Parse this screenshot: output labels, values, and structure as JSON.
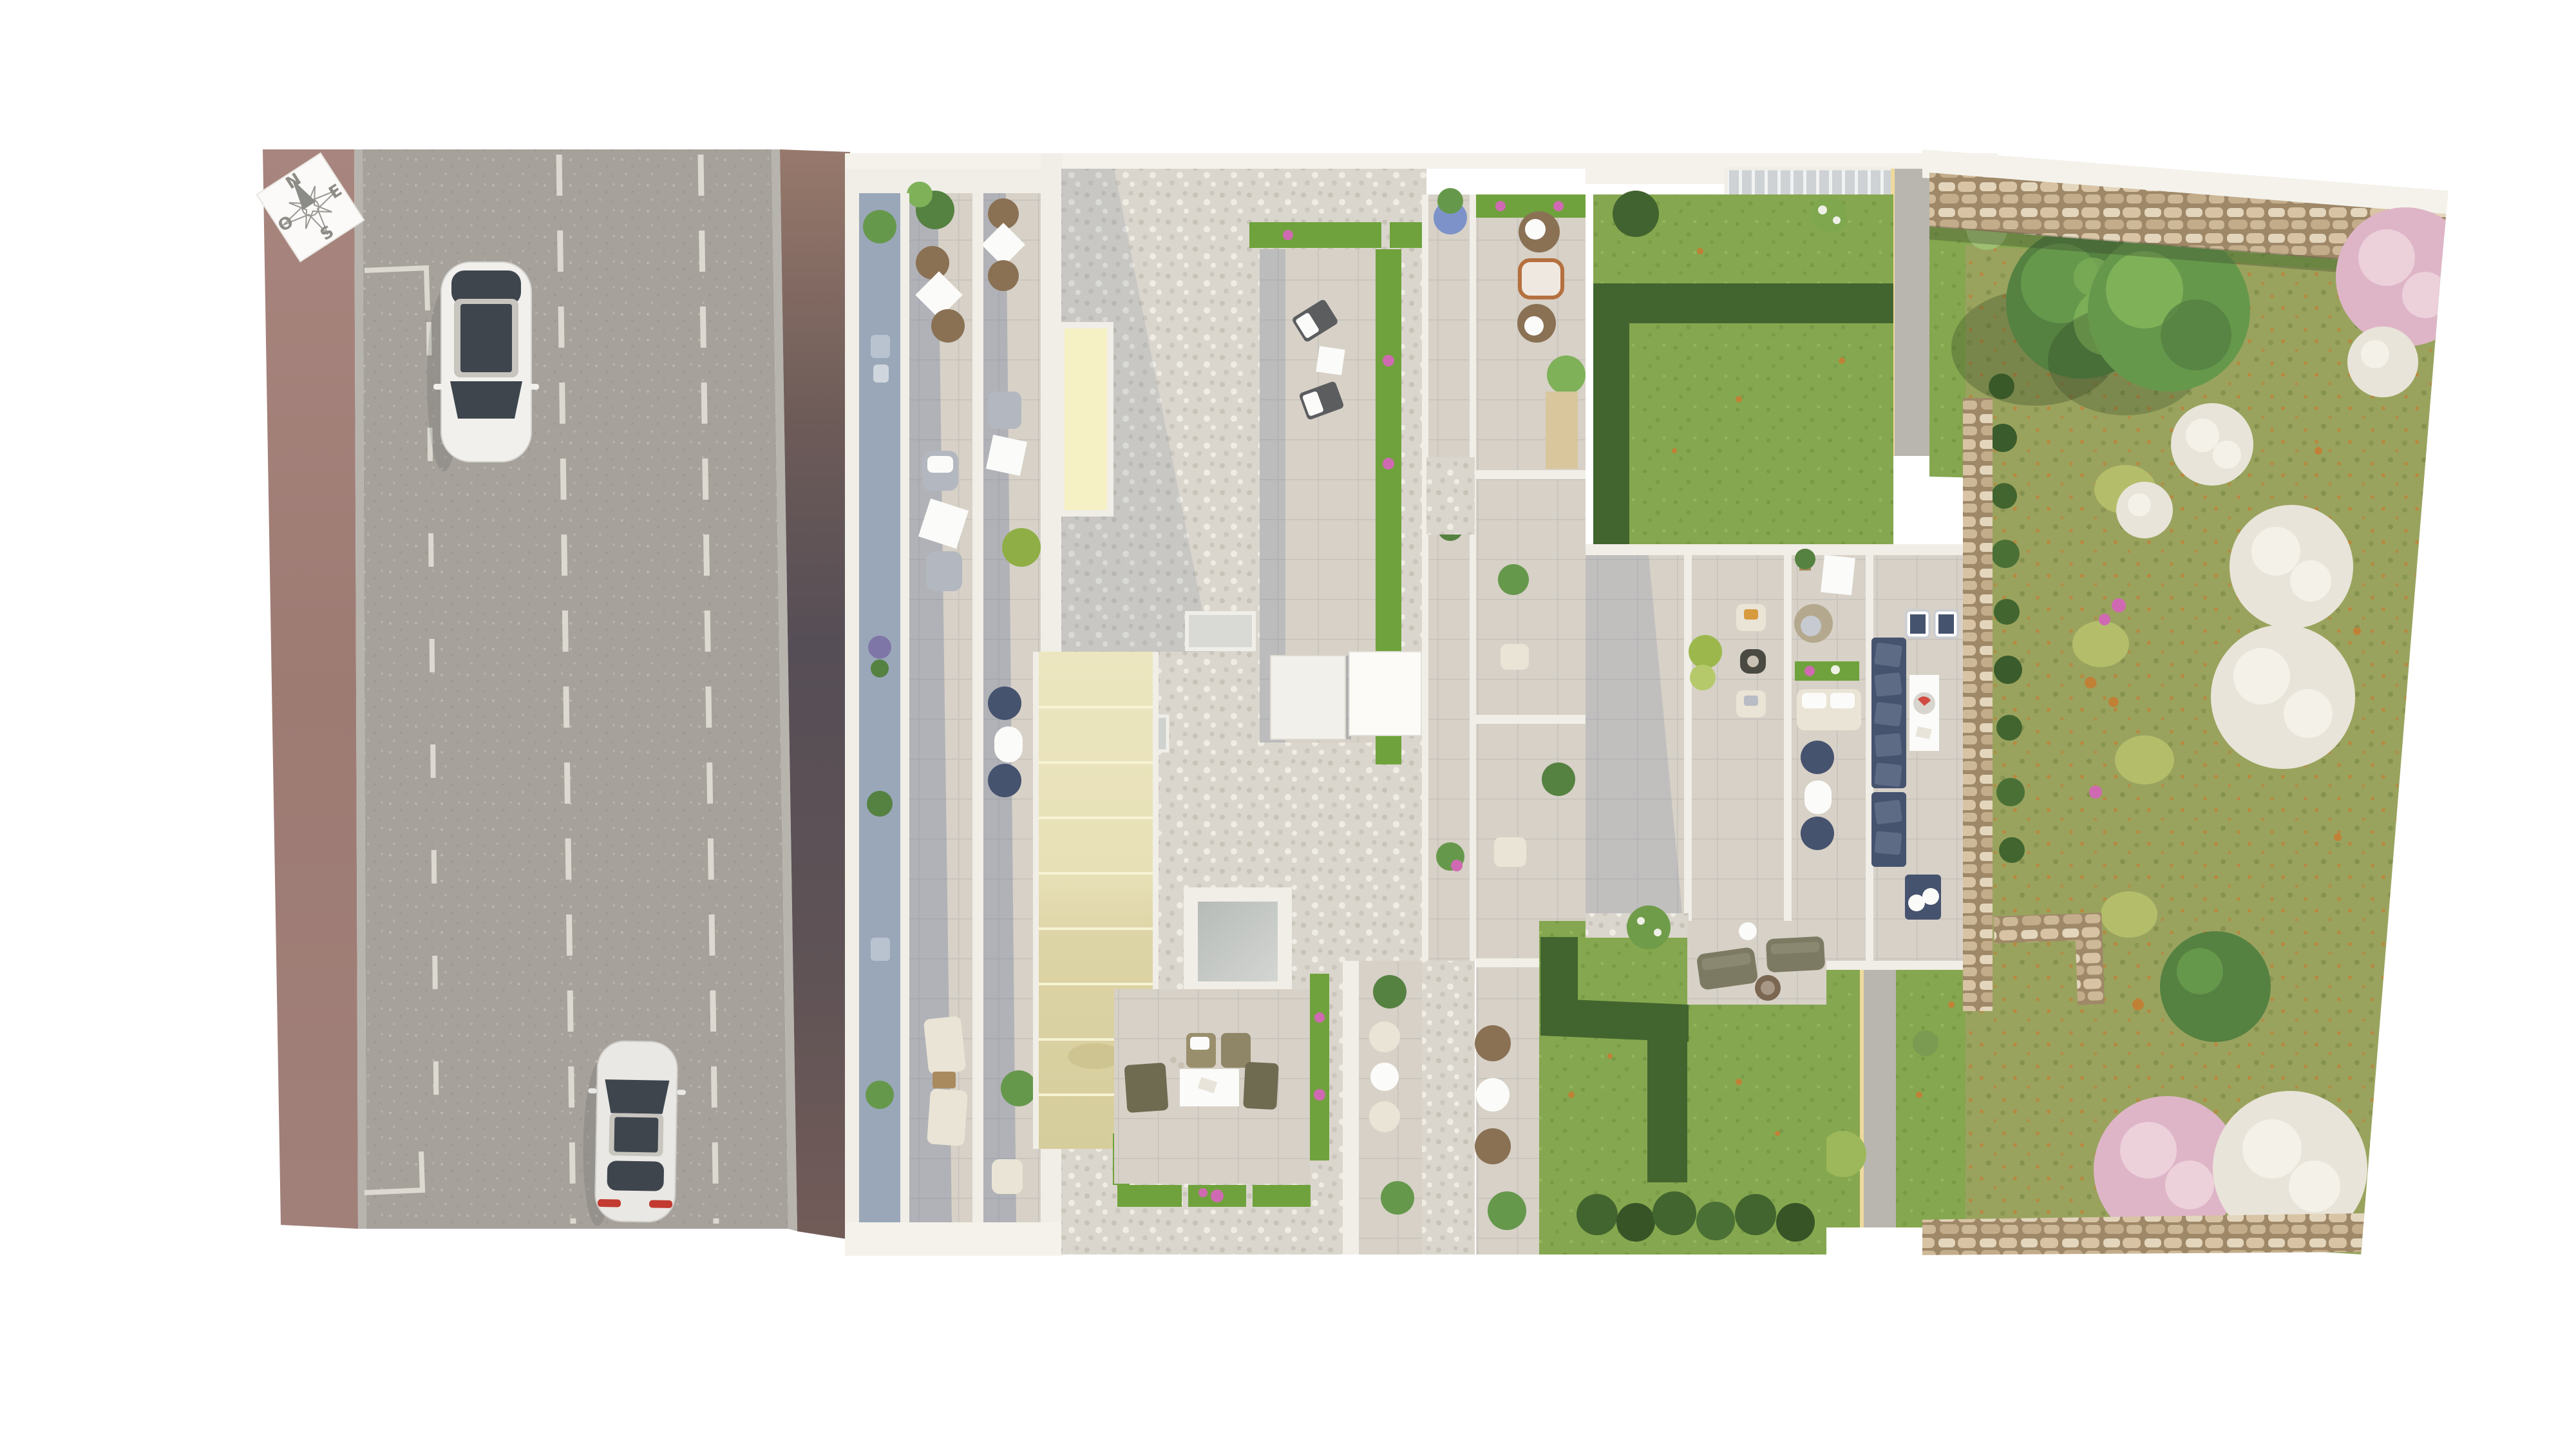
{
  "scene": {
    "type": "aerial-architectural-site-plan",
    "description": "Top-down photorealistic render of a residential building: street with two white cars on the left, white-gravel roof with terraces, skylights and a cream awning in the middle, private lawns, stone walls, hedges and a wildflower meadow with blossom trees on the right.",
    "compass": {
      "n": "N",
      "e": "E",
      "s": "S",
      "o": "O"
    },
    "road": {
      "surface": "asphalt",
      "lane_dashed_lines": 2,
      "parking_bays": 2,
      "cars": [
        {
          "name": "car-top",
          "body": "white",
          "heading": "south",
          "roof": "dark glass"
        },
        {
          "name": "car-bottom",
          "body": "white",
          "heading": "north",
          "taillights": "red"
        }
      ]
    },
    "building": {
      "roof": "white pebble gravel",
      "skylights": [
        "pale-yellow strip",
        "twin white roof hatch",
        "large gray skylight",
        "two small gray skylights"
      ],
      "awning": "long cream slatted pergola",
      "terraces": "beige tiled rooftop terraces with parapets, planters and outdoor furniture",
      "furniture": [
        "brown round chairs",
        "gray armchairs",
        "cream loungers",
        "navy corner sofa",
        "white dining tables",
        "fire-pit table",
        "wicker chairs with rug"
      ]
    },
    "gardens": {
      "lawns": 4,
      "hedges": "clipped dark green bands",
      "walls": "dry-stone gabion walls on north, east and south edges",
      "trees": [
        "two large green canopies",
        "pink blossom trees",
        "white blossom trees"
      ],
      "meadow": "olive wildflower strip with orange leaf litter along the right edge",
      "paths": [
        "gray concrete path with cream edge",
        "sandy path"
      ]
    }
  },
  "colors": {
    "curb": "#b7b4ae",
    "road": "#a6a19a",
    "roadDot1": "#c9c4b8",
    "roadDot2": "#8f8a82",
    "marking": "#dcd9d1",
    "carBody": "#f1f0ed",
    "carBody2": "#e9e8e4",
    "carGlass": "#3e454d",
    "carRoof": "#c8c5bf",
    "carTail": "#c23a30",
    "parapet": "#f0eee7",
    "slabTop": "#f4f2eb",
    "balcony": "#9aa7b9",
    "tile": "#d7d1c7",
    "tileLine": "rgba(110,118,135,0.16)",
    "tileShadow": "rgba(96,112,148,0.32)",
    "gravel": "#dad6cd",
    "gravelDot": "#b7b2a5",
    "gravelDot2": "#efece4",
    "yellowSky": "#f5f1c4",
    "awnLight": "#ece6c0",
    "awnDark": "#d6cd9c",
    "awnLine": "#f7f3d4",
    "planter": "#6fa23c",
    "flowerPink": "#cf6ab2",
    "hedge": "#42652f",
    "lawn": "#85a74f",
    "lawnDot": "#6d8f3f",
    "meadow": "#99a35e",
    "meadowDot": "#c08137",
    "stone": "#cdb897",
    "stoneDark": "#9f8868",
    "stoneLight": "#e3d6bd",
    "louver": "#ced2d5",
    "path": "#b9b6b0",
    "pathEdge": "#eeda9d",
    "sand": "#d9c69d",
    "navy": "#46536f",
    "navyLight": "#5d6b85",
    "cream": "#e9e4d5",
    "olive": "#6f6b51",
    "oliveSofa": "#7c7a62",
    "wood": "#a98a5f",
    "wicker": "#8a7154",
    "treeG1": "#558141",
    "treeG2": "#66984c",
    "treeG3": "#7fb159",
    "treePink": "#deb5c7",
    "treePinkL": "#ecd0da",
    "treeWhite": "#e9e4d9",
    "treeWhiteL": "#f4f1e9",
    "skyGray": "#bcc0bd",
    "shadow": "rgba(70,90,130,0.25)",
    "compassInk": "#8f8c86",
    "sidewalkTop": "#a8867e",
    "sidewalkDark": "#564e55"
  }
}
